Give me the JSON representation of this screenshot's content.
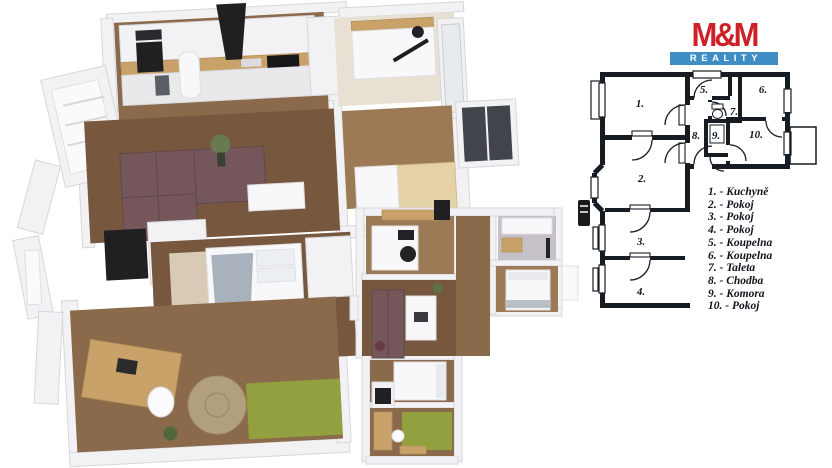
{
  "logo": {
    "brand": "M&M",
    "subtitle": "REALITY",
    "brand_color": "#cd2127",
    "band_color": "#3f8dc5"
  },
  "plan2d": {
    "room_numbers": {
      "r1": "1.",
      "r2": "2.",
      "r3": "3.",
      "r4": "4.",
      "r5": "5.",
      "r6": "6.",
      "r7": "7.",
      "r8": "8.",
      "r9": "9.",
      "r10": "10."
    }
  },
  "legend": {
    "items": [
      "1. - Kuchyně",
      "2. - Pokoj",
      "3. - Pokoj",
      "4. - Pokoj",
      "5. - Koupelna",
      "6. - Koupelna",
      "7. - Taleta",
      "8. - Chodba",
      "9. - Komora",
      "10. - Pokoj"
    ]
  }
}
